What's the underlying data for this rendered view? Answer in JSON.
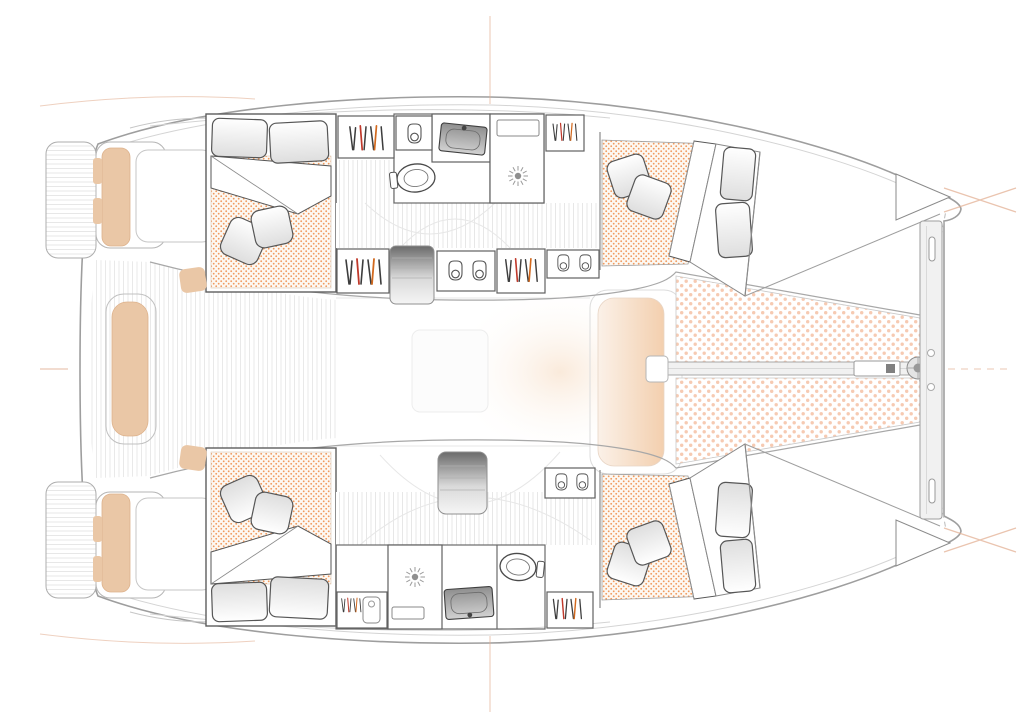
{
  "meta": {
    "title": "Catamaran interior deck plan",
    "type": "floor-plan",
    "view": "top-down",
    "visible_features": {
      "cabins_with_double_berths": 4,
      "bathrooms": 2,
      "shower_stalls": 2,
      "toilets": 2,
      "sinks": 2,
      "trampolines": 2,
      "companionway_stairs": 2,
      "stern_platforms": 2
    }
  },
  "colors": {
    "hull_outline": "#9e9e9e",
    "furniture_line": "#5d5d5d",
    "cushion_tan": "#eac7a6",
    "cushion_tan_edge": "#ddb28c",
    "mattress_dot": "#f09a5f",
    "mattress_bg": "#fdf8f2",
    "trampoline_dot": "#f6cab2",
    "deck_plank": "#e2e2e2",
    "stairs_dark": "#6b6b6b",
    "stairs_mid": "#d9d9d9",
    "stairs_light": "#f5f5f5",
    "accent_red": "#c0392b",
    "accent_orange": "#d2691e",
    "peach_strong": "#f3cfae",
    "peach_faint": "#fbf1e8",
    "mark_orange": "#e3b094",
    "sink_dark": "#8f8f8f",
    "sink_light": "#d2d2d2"
  },
  "icons": {
    "hanging_clothes": "wardrobe-hanging-clothes-icon",
    "hanger_hook": "hanging-locker-hook-icon",
    "shower_drain": "shower-drain-icon",
    "toilet": "toilet-icon",
    "sink": "sink-basin-icon",
    "forestay_fitting": "forestay-chainplate-icon"
  },
  "regions": {
    "port_hull_aft": "double berth cabin",
    "port_hull_mid": "bathroom with shower, toilet, sink and wardrobes",
    "port_hull_fwd": "double berth cabin",
    "starboard_hull_aft": "double berth cabin",
    "starboard_hull_mid": "bathroom with shower, toilet, sink and wardrobes",
    "starboard_hull_fwd": "double berth cabin",
    "aft_deck": "cockpit with bench seats and swim platforms",
    "saloon": "bridgedeck saloon",
    "foredeck": "forward cockpit bench and twin trampolines"
  }
}
